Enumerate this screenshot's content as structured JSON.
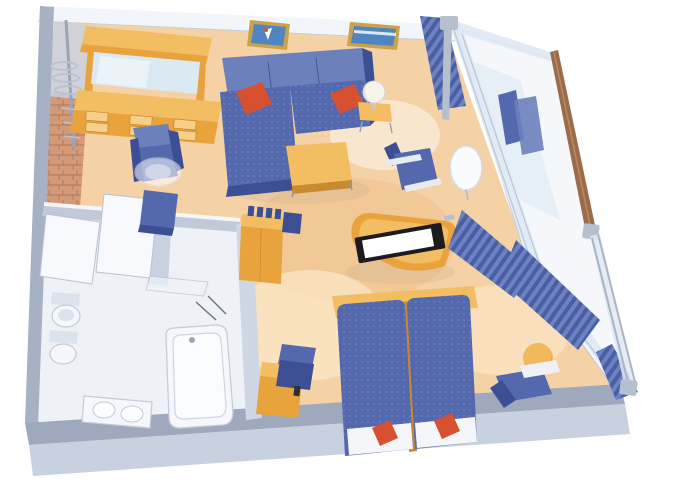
{
  "meta": {
    "type": "isometric-floorplan",
    "subject": "cruise-ship-suite-stateroom-with-balcony"
  },
  "colors": {
    "white": "#ffffff",
    "floor": "#f4d2a6",
    "floorDeep": "#eab878",
    "floorPool": "#fdecd0",
    "wood": "#e8a33d",
    "woodLight": "#f3bd62",
    "woodPale": "#f6cf8a",
    "woodDark": "#c98a2e",
    "blue": "#5468ae",
    "blueDark": "#3d4f94",
    "blueLight": "#6c80bc",
    "red": "#d7502f",
    "wallGray": "#a7b1c4",
    "wallLight": "#c9d2e1",
    "wallPale": "#eef1f6",
    "bandTop": "#9ea9bd",
    "bandFront": "#c8d1e0",
    "glass": "#dfe9f4",
    "glassEdge": "#b9c6d6",
    "metal": "#b6bfcd",
    "rail": "#9c6b49",
    "bathWhite": "#f5f7fa",
    "bathShade": "#dde3ec",
    "lineGray": "#c3cbd8",
    "mirror": "#dbe9f2",
    "frameGold": "#c9a24b",
    "pictureBlue": "#4f86c2",
    "lamp": "#f6f3ea",
    "tvBlack": "#1c1c20",
    "screenWhite": "#ffffff",
    "curtainA": "#4a5ea6",
    "curtainB": "#6d82c0",
    "entryBrick": "#d29a79",
    "entryLine": "#b0785c",
    "shadowTint": "#c9b390"
  }
}
